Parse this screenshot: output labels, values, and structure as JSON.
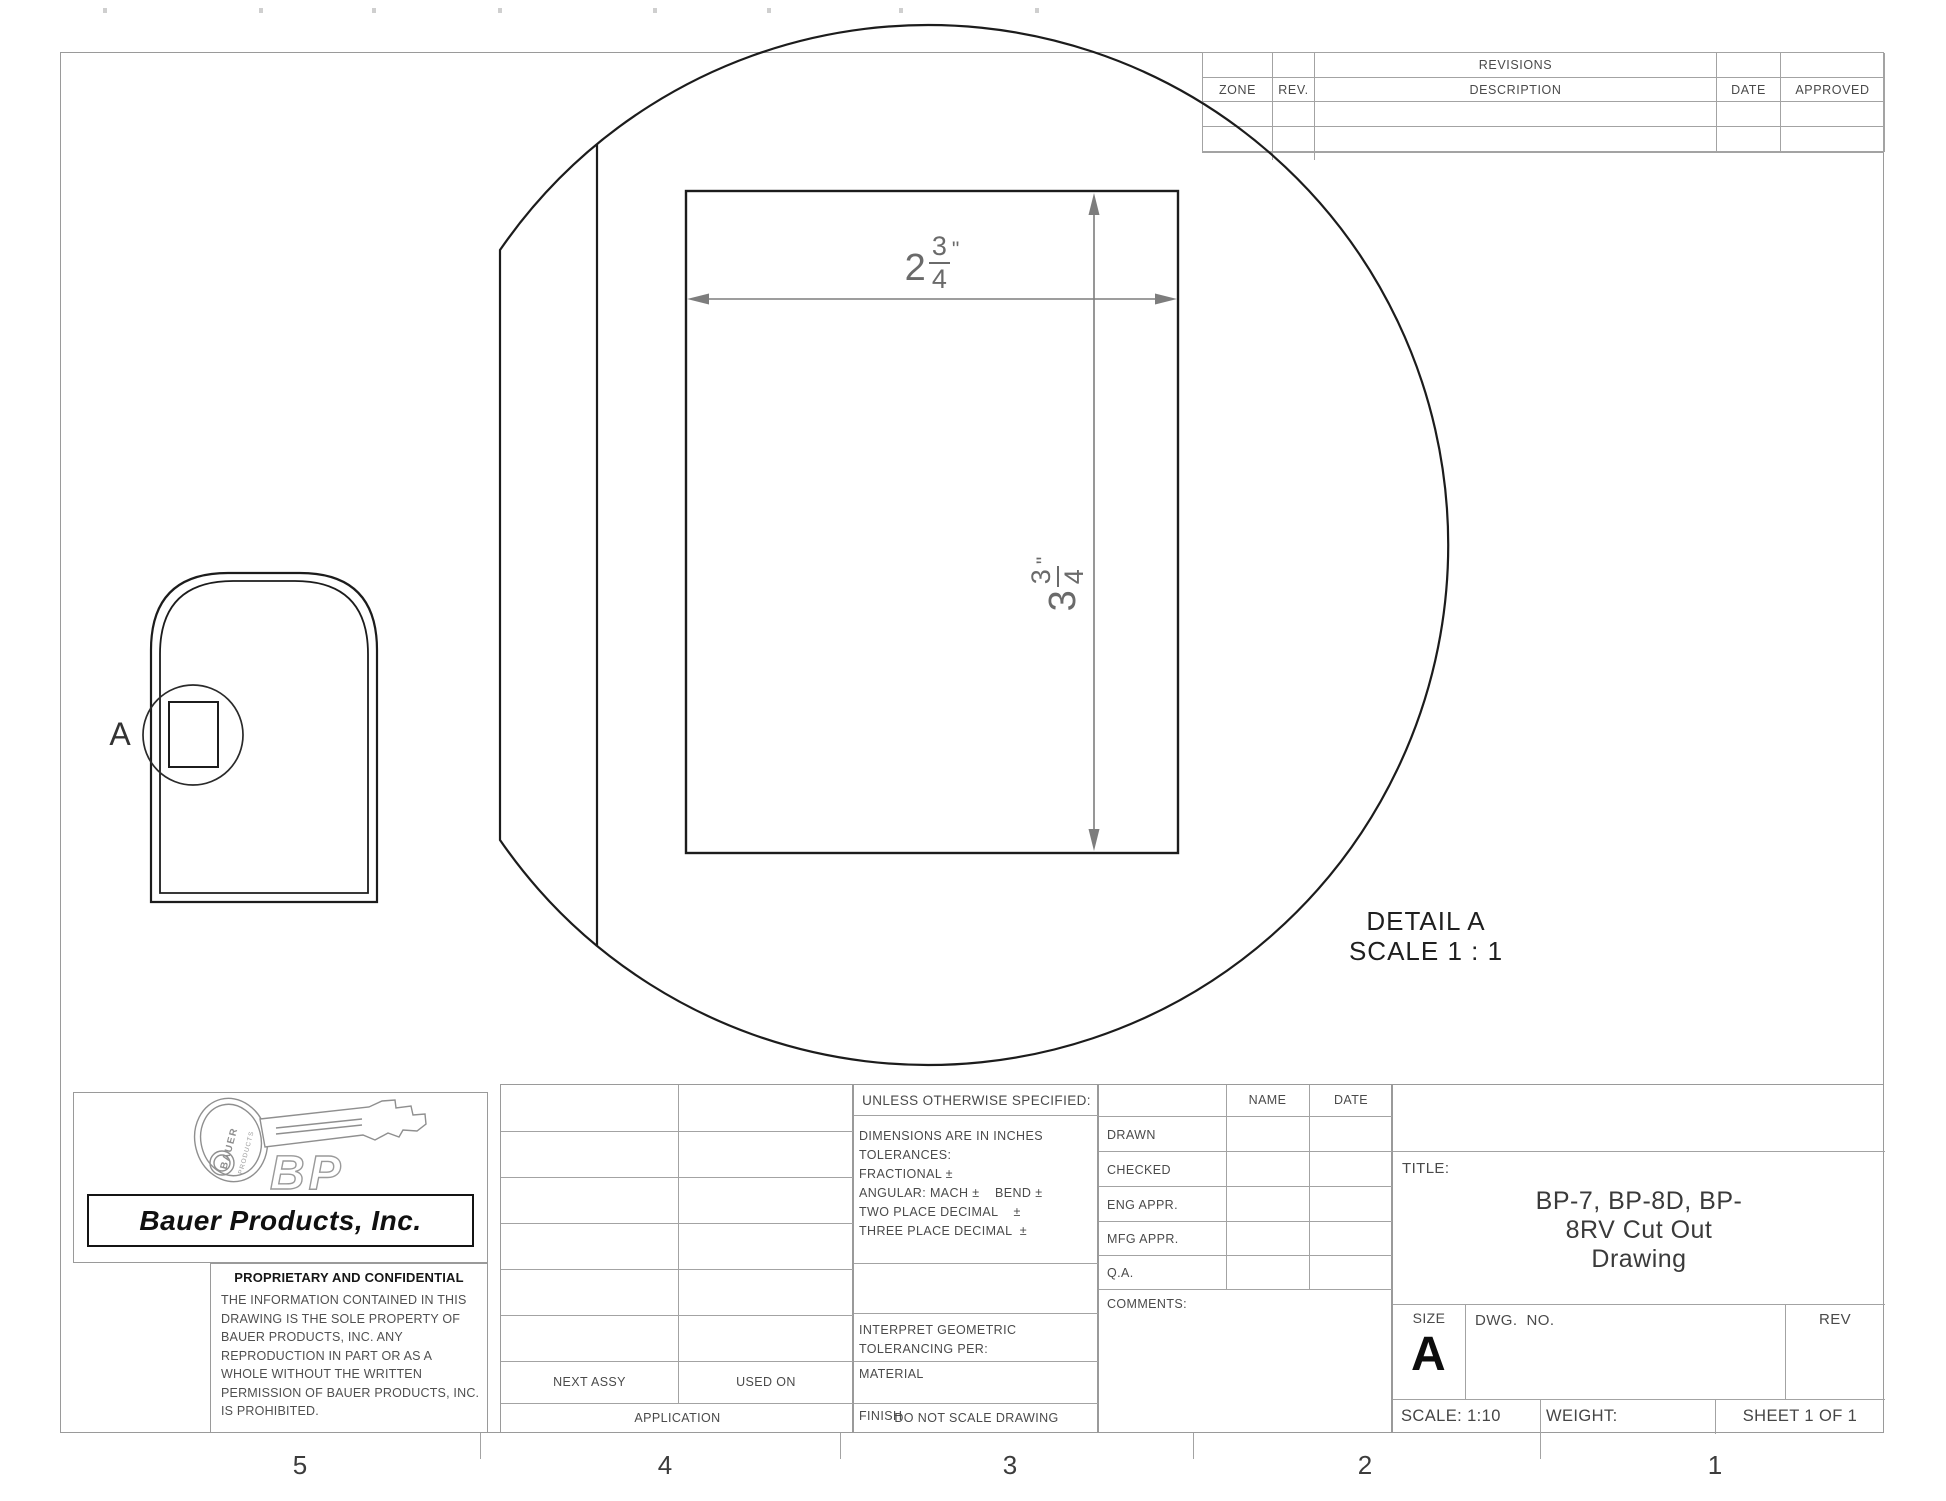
{
  "revisions": {
    "title": "REVISIONS",
    "col_zone": "ZONE",
    "col_rev": "REV.",
    "col_description": "DESCRIPTION",
    "col_date": "DATE",
    "col_approved": "APPROVED"
  },
  "detail": {
    "marker": "A",
    "title": "DETAIL A",
    "scale": "SCALE 1 : 1"
  },
  "dimensions": {
    "width": {
      "whole": "2",
      "numerator": "3",
      "denominator": "4",
      "unit": "\""
    },
    "height": {
      "whole": "3",
      "numerator": "3",
      "denominator": "4",
      "unit": "\""
    }
  },
  "logo": {
    "company": "Bauer Products, Inc.",
    "monogram": "BP",
    "key_label_top": "BAUER",
    "key_label_bottom": "PRODUCTS"
  },
  "proprietary": {
    "heading": "PROPRIETARY AND CONFIDENTIAL",
    "body": "THE INFORMATION CONTAINED IN THIS DRAWING IS THE SOLE PROPERTY OF BAUER PRODUCTS, INC.  ANY REPRODUCTION IN PART OR AS A WHOLE WITHOUT THE WRITTEN PERMISSION OF BAUER PRODUCTS, INC. IS PROHIBITED."
  },
  "application": {
    "next_assy": "NEXT ASSY",
    "used_on": "USED ON",
    "label": "APPLICATION"
  },
  "tolerances": {
    "heading": "UNLESS OTHERWISE SPECIFIED:",
    "line1": "DIMENSIONS ARE IN INCHES",
    "line2": "TOLERANCES:",
    "line3": "FRACTIONAL ±",
    "line4": "ANGULAR: MACH ±    BEND ±",
    "line5": "TWO PLACE DECIMAL    ±",
    "line6": "THREE PLACE DECIMAL  ±",
    "interpret": "INTERPRET GEOMETRIC TOLERANCING PER:",
    "material": "MATERIAL",
    "finish": "FINISH",
    "do_not_scale": "DO NOT SCALE DRAWING"
  },
  "signoff": {
    "col_name": "NAME",
    "col_date": "DATE",
    "rows": [
      {
        "label": "DRAWN"
      },
      {
        "label": "CHECKED"
      },
      {
        "label": "ENG APPR."
      },
      {
        "label": "MFG APPR."
      },
      {
        "label": "Q.A."
      }
    ],
    "comments": "COMMENTS:"
  },
  "title_block": {
    "title_label": "TITLE:",
    "title_line1": "BP-7, BP-8D, BP-",
    "title_line2": "8RV Cut Out",
    "title_line3": "Drawing",
    "size_label": "SIZE",
    "size": "A",
    "dwg_label": "DWG.  NO.",
    "rev_label": "REV",
    "scale": "SCALE: 1:10",
    "weight": "WEIGHT:",
    "sheet": "SHEET 1 OF 1"
  },
  "zones": {
    "labels": [
      "5",
      "4",
      "3",
      "2",
      "1"
    ]
  }
}
